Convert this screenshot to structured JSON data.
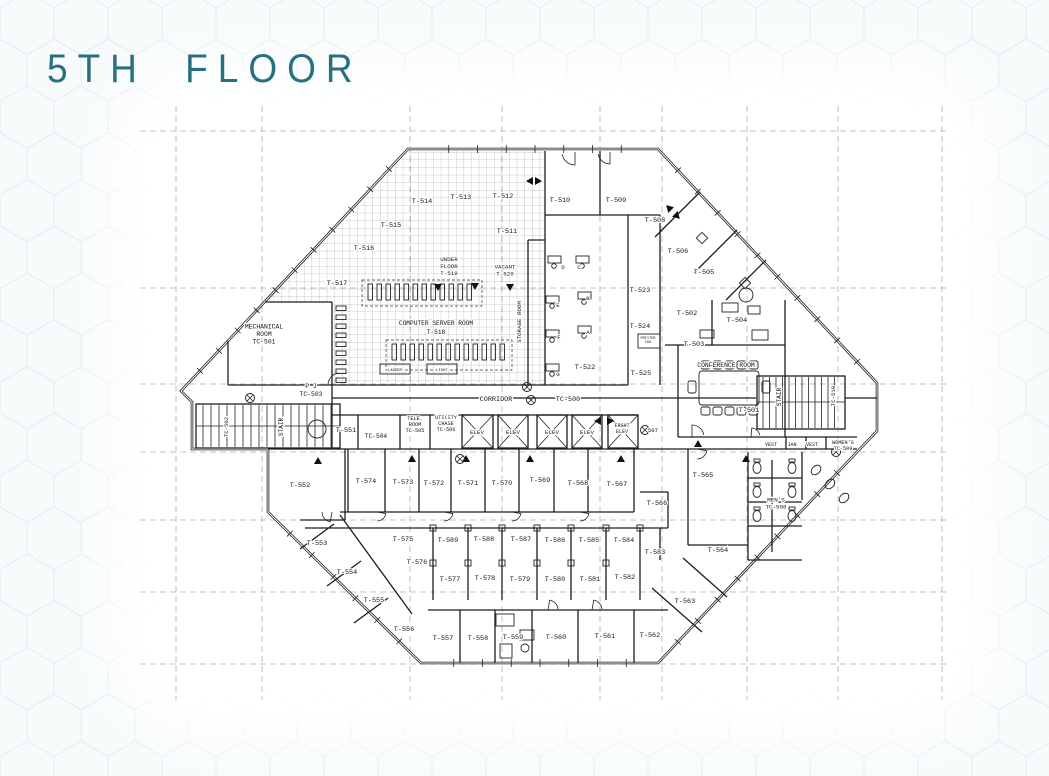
{
  "title": "5TH FLOOR",
  "colors": {
    "title_accent": "#27707f",
    "wall": "#1b1b1b",
    "grid": "#a8b2b8",
    "hex_pattern": "#e4edf2"
  },
  "plan": {
    "elevator_labels": [
      "ELEV",
      "ELEV",
      "ELEV",
      "ELEV",
      "FRGHT ELEV"
    ],
    "labels": [
      {
        "t": "T-514",
        "x": 422,
        "y": 203
      },
      {
        "t": "T-513",
        "x": 461,
        "y": 199
      },
      {
        "t": "T-512",
        "x": 503,
        "y": 198
      },
      {
        "t": "T-515",
        "x": 391,
        "y": 227
      },
      {
        "t": "T-516",
        "x": 364,
        "y": 250
      },
      {
        "t": "T-517",
        "x": 337,
        "y": 285
      },
      {
        "t": "T-511",
        "x": 507,
        "y": 233
      },
      {
        "t": "UNDER\nFLOOR\nT-519",
        "x": 449,
        "y": 268,
        "s": 5.8
      },
      {
        "t": "VACANT\nT-520",
        "x": 505,
        "y": 272,
        "s": 5.8
      },
      {
        "t": "T-510",
        "x": 560,
        "y": 202
      },
      {
        "t": "T-509",
        "x": 616,
        "y": 202
      },
      {
        "t": "T-508",
        "x": 655,
        "y": 222
      },
      {
        "t": "T-506",
        "x": 678,
        "y": 253
      },
      {
        "t": "T-505",
        "x": 704,
        "y": 274
      },
      {
        "t": "T-502",
        "x": 687,
        "y": 315
      },
      {
        "t": "T-504",
        "x": 737,
        "y": 322
      },
      {
        "t": "T-503",
        "x": 694,
        "y": 346
      },
      {
        "t": "T-523",
        "x": 640,
        "y": 292
      },
      {
        "t": "T-524",
        "x": 640,
        "y": 328
      },
      {
        "t": "T-525",
        "x": 641,
        "y": 375
      },
      {
        "t": "PRINTER\nFAX",
        "x": 648,
        "y": 341,
        "s": 3.6
      },
      {
        "t": "T-522",
        "x": 585,
        "y": 369
      },
      {
        "t": "D",
        "x": 563,
        "y": 269,
        "s": 5.8
      },
      {
        "t": "C",
        "x": 579,
        "y": 269,
        "s": 5.8
      },
      {
        "t": "E",
        "x": 558,
        "y": 307,
        "s": 5.8
      },
      {
        "t": "B",
        "x": 588,
        "y": 300,
        "s": 5.8
      },
      {
        "t": "F",
        "x": 559,
        "y": 339,
        "s": 5.8
      },
      {
        "t": "A",
        "x": 588,
        "y": 334,
        "s": 5.8
      },
      {
        "t": "G",
        "x": 558,
        "y": 376,
        "s": 5.8
      },
      {
        "t": "COMPUTER SERVER ROOM",
        "x": 436,
        "y": 325,
        "s": 6.2
      },
      {
        "t": "T-518",
        "x": 436,
        "y": 334,
        "s": 6.2
      },
      {
        "t": "STORAGE ROOM",
        "x": 521,
        "y": 322,
        "s": 5.8,
        "r": -90
      },
      {
        "t": "LADDER",
        "x": 395,
        "y": 371,
        "s": 3.8
      },
      {
        "t": "LIGHT",
        "x": 442,
        "y": 371,
        "s": 3.8
      },
      {
        "t": "MECHANICAL\nROOM\nTC-501",
        "x": 264,
        "y": 336,
        "s": 6.4
      },
      {
        "t": "P J\nTC-503",
        "x": 311,
        "y": 392,
        "s": 6.4
      },
      {
        "t": "CONFERENCE ROOM",
        "x": 726,
        "y": 367,
        "s": 6.4
      },
      {
        "t": "T-501",
        "x": 749,
        "y": 412
      },
      {
        "t": "STAIR",
        "x": 781,
        "y": 397,
        "s": 6.2,
        "r": -90
      },
      {
        "t": "TC-510",
        "x": 835,
        "y": 396,
        "s": 5.6,
        "r": -90
      },
      {
        "t": "STAIR",
        "x": 283,
        "y": 427,
        "s": 6.2,
        "r": -90
      },
      {
        "t": "TC-502",
        "x": 228,
        "y": 427,
        "s": 5.6,
        "r": -90
      },
      {
        "t": "CORRIDOR",
        "x": 496,
        "y": 401,
        "s": 6.8
      },
      {
        "t": "TC-500",
        "x": 568,
        "y": 401,
        "s": 6.8
      },
      {
        "t": "507",
        "x": 653,
        "y": 432,
        "s": 5.6
      },
      {
        "t": "T-551",
        "x": 346,
        "y": 432
      },
      {
        "t": "TC-504",
        "x": 376,
        "y": 438,
        "s": 6.2
      },
      {
        "t": "TELE.\nROOM\nTC-505",
        "x": 415,
        "y": 426,
        "s": 5.2
      },
      {
        "t": "UTILITY\nCHASE\nTC-506",
        "x": 446,
        "y": 425,
        "s": 5.2
      },
      {
        "t": "ELEV",
        "x": 477,
        "y": 434,
        "s": 5.8
      },
      {
        "t": "ELEV",
        "x": 513,
        "y": 434,
        "s": 5.8
      },
      {
        "t": "ELEV",
        "x": 552,
        "y": 434,
        "s": 5.8
      },
      {
        "t": "ELEV",
        "x": 587,
        "y": 434,
        "s": 5.8
      },
      {
        "t": "FRGHT\nELEV",
        "x": 622,
        "y": 430,
        "s": 5
      },
      {
        "t": "VEST",
        "x": 771,
        "y": 446,
        "s": 5
      },
      {
        "t": "JAN",
        "x": 792,
        "y": 446,
        "s": 5
      },
      {
        "t": "VEST",
        "x": 812,
        "y": 446,
        "s": 5
      },
      {
        "t": "WOMEN'S\nTC-509",
        "x": 843,
        "y": 447,
        "s": 5.2
      },
      {
        "t": "MEN'S\nTC-508",
        "x": 776,
        "y": 505,
        "s": 5.8
      },
      {
        "t": "T-552",
        "x": 300,
        "y": 487
      },
      {
        "t": "T-574",
        "x": 366,
        "y": 483
      },
      {
        "t": "T-573",
        "x": 403,
        "y": 484
      },
      {
        "t": "T-572",
        "x": 434,
        "y": 485
      },
      {
        "t": "T-571",
        "x": 468,
        "y": 485
      },
      {
        "t": "T-570",
        "x": 502,
        "y": 485
      },
      {
        "t": "T-569",
        "x": 540,
        "y": 482
      },
      {
        "t": "T-568",
        "x": 578,
        "y": 485
      },
      {
        "t": "T-567",
        "x": 617,
        "y": 486
      },
      {
        "t": "T-566",
        "x": 657,
        "y": 505
      },
      {
        "t": "T-565",
        "x": 703,
        "y": 477
      },
      {
        "t": "T-564",
        "x": 718,
        "y": 552
      },
      {
        "t": "T-583",
        "x": 655,
        "y": 554
      },
      {
        "t": "T-563",
        "x": 685,
        "y": 603
      },
      {
        "t": "T-562",
        "x": 650,
        "y": 637
      },
      {
        "t": "T-561",
        "x": 605,
        "y": 638
      },
      {
        "t": "T-560",
        "x": 556,
        "y": 639
      },
      {
        "t": "T-553",
        "x": 317,
        "y": 545
      },
      {
        "t": "T-554",
        "x": 347,
        "y": 574
      },
      {
        "t": "T-555",
        "x": 374,
        "y": 602
      },
      {
        "t": "T-556",
        "x": 404,
        "y": 631
      },
      {
        "t": "T-575",
        "x": 403,
        "y": 541
      },
      {
        "t": "T-576",
        "x": 417,
        "y": 564
      },
      {
        "t": "T-589",
        "x": 448,
        "y": 542
      },
      {
        "t": "T-588",
        "x": 484,
        "y": 541
      },
      {
        "t": "T-587",
        "x": 521,
        "y": 541
      },
      {
        "t": "T-586",
        "x": 555,
        "y": 542
      },
      {
        "t": "T-585",
        "x": 589,
        "y": 542
      },
      {
        "t": "T-584",
        "x": 624,
        "y": 542
      },
      {
        "t": "T-577",
        "x": 450,
        "y": 581
      },
      {
        "t": "T-578",
        "x": 485,
        "y": 580
      },
      {
        "t": "T-579",
        "x": 520,
        "y": 581
      },
      {
        "t": "T-580",
        "x": 555,
        "y": 581
      },
      {
        "t": "T-581",
        "x": 590,
        "y": 581
      },
      {
        "t": "T-582",
        "x": 625,
        "y": 579
      },
      {
        "t": "T-557",
        "x": 443,
        "y": 640
      },
      {
        "t": "T-558",
        "x": 478,
        "y": 640
      },
      {
        "t": "T-559",
        "x": 513,
        "y": 639
      }
    ]
  }
}
